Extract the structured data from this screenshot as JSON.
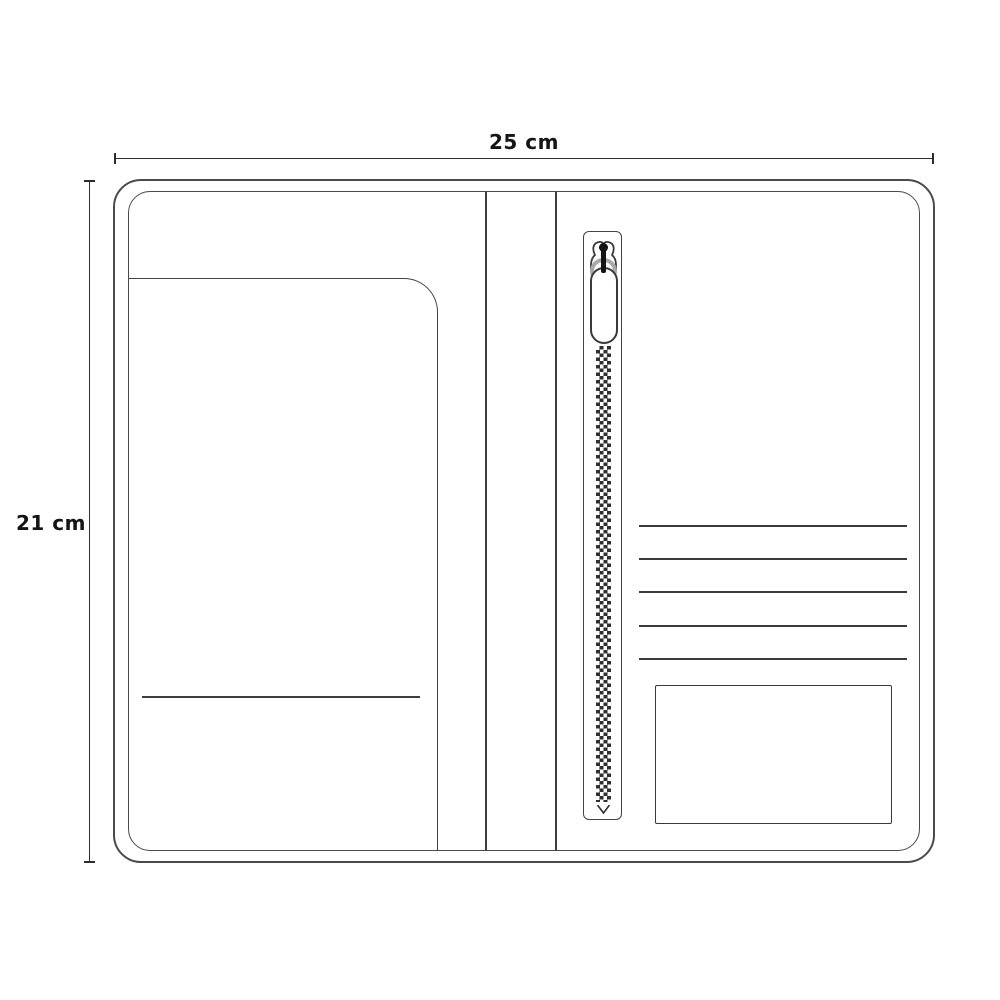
{
  "diagram": {
    "width_label": "25 cm",
    "height_label": "21 cm",
    "card_slot_count": 5,
    "parts": {
      "wallet": "travel-wallet-outline",
      "left_panel": "left-pocket",
      "slit": "left-pocket-slit-line",
      "spine": "center-spine-lines",
      "zipper": "vertical-zipper-with-pull",
      "card_slots": "card-slot-lines",
      "bottom_right": "bottom-right-pocket"
    },
    "colors": {
      "background": "#ffffff",
      "outline": "#4a4a4a",
      "detail_line": "#3a3a3a",
      "dimension": "#2d2d2d",
      "text": "#151515",
      "zipper_teeth": "#2f2f2f",
      "zipper_ring": "#a8a8a8"
    }
  }
}
